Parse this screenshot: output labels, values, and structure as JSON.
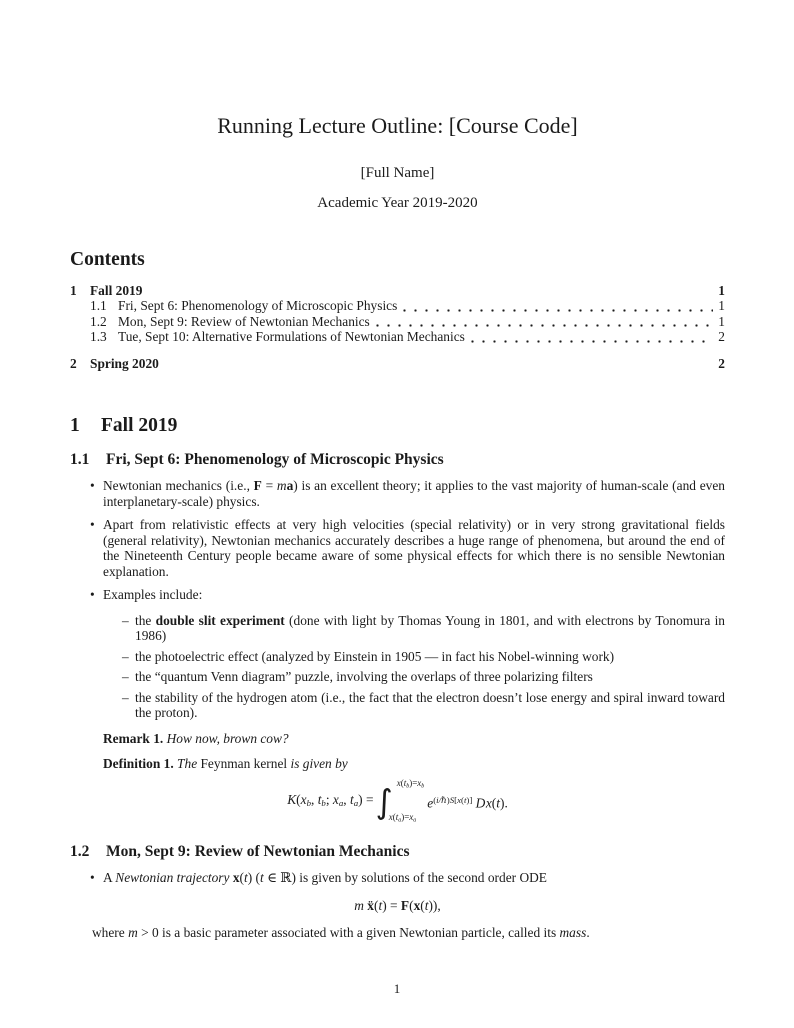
{
  "page": {
    "title": "Running Lecture Outline: [Course Code]",
    "author": "[Full Name]",
    "date": "Academic Year 2019-2020",
    "page_number": "1"
  },
  "markers": {
    "bullet": "•",
    "dash": "–"
  },
  "contents": {
    "heading": "Contents",
    "entries": [
      {
        "num": "1",
        "label": "Fall 2019",
        "page": "1"
      },
      {
        "num": "1.1",
        "label": "Fri, Sept 6: Phenomenology of Microscopic Physics",
        "page": "1"
      },
      {
        "num": "1.2",
        "label": "Mon, Sept 9: Review of Newtonian Mechanics",
        "page": "1"
      },
      {
        "num": "1.3",
        "label": "Tue, Sept 10: Alternative Formulations of Newtonian Mechanics",
        "page": "2"
      },
      {
        "num": "2",
        "label": "Spring 2020",
        "page": "2"
      }
    ]
  },
  "sections": {
    "s1": {
      "num": "1",
      "title": "Fall 2019"
    },
    "s11": {
      "num": "1.1",
      "title": "Fri, Sept 6: Phenomenology of Microscopic Physics"
    },
    "s12": {
      "num": "1.2",
      "title": "Mon, Sept 9: Review of Newtonian Mechanics"
    }
  },
  "body": {
    "bullet1": [
      {
        "t": "Newtonian mechanics (i.e., ",
        "s": "rm"
      },
      {
        "t": "F",
        "s": "bf"
      },
      {
        "t": " = ",
        "s": "rm"
      },
      {
        "t": "m",
        "s": "it"
      },
      {
        "t": "a",
        "s": "bf"
      },
      {
        "t": ") is an excellent theory; it applies to the vast majority of human-scale (and even interplanetary-scale) physics.",
        "s": "rm"
      }
    ],
    "bullet2": [
      {
        "t": "Apart from relativistic effects at very high velocities (special relativity) or in very strong gravitational fields (general relativity), Newtonian mechanics accurately describes a huge range of phenomena, but around the end of the Nineteenth Century people became aware of some physical effects for which there is no sensible Newtonian explanation.",
        "s": "rm"
      }
    ],
    "bullet3": [
      {
        "t": "Examples include:",
        "s": "rm"
      }
    ],
    "subs": [
      [
        {
          "t": "the ",
          "s": "rm"
        },
        {
          "t": "double slit experiment",
          "s": "bf"
        },
        {
          "t": " (done with light by Thomas Young in 1801, and with electrons by Tonomura in 1986)",
          "s": "rm"
        }
      ],
      [
        {
          "t": "the photoelectric effect (analyzed by Einstein in 1905 — in fact his Nobel-winning work)",
          "s": "rm"
        }
      ],
      [
        {
          "t": "the “quantum Venn diagram” puzzle, involving the overlaps of three polarizing filters",
          "s": "rm"
        }
      ],
      [
        {
          "t": "the stability of the hydrogen atom (i.e., the fact that the electron doesn’t lose energy and spiral inward toward the proton).",
          "s": "rm"
        }
      ]
    ],
    "remark": [
      {
        "t": "Remark 1.",
        "s": "bf"
      },
      {
        "t": " ",
        "s": "rm"
      },
      {
        "t": "How now, brown cow?",
        "s": "it"
      }
    ],
    "definition": [
      {
        "t": "Definition 1.",
        "s": "bf"
      },
      {
        "t": " ",
        "s": "rm"
      },
      {
        "t": "The ",
        "s": "it"
      },
      {
        "t": "Feynman kernel",
        "s": "rm"
      },
      {
        "t": " is given by",
        "s": "it"
      }
    ],
    "traj": [
      {
        "t": "A ",
        "s": "rm"
      },
      {
        "t": "Newtonian trajectory ",
        "s": "it"
      },
      {
        "t": "x",
        "s": "bf"
      },
      {
        "t": "(",
        "s": "rm"
      },
      {
        "t": "t",
        "s": "it"
      },
      {
        "t": ") (",
        "s": "rm"
      },
      {
        "t": "t",
        "s": "it"
      },
      {
        "t": " ∈ ℝ) is given by solutions of the second order ODE",
        "s": "rm"
      }
    ],
    "where_line": [
      {
        "t": "where ",
        "s": "rm"
      },
      {
        "t": "m",
        "s": "it"
      },
      {
        "t": " > 0 is a basic parameter associated with a given Newtonian particle, called its ",
        "s": "rm"
      },
      {
        "t": "mass",
        "s": "it"
      },
      {
        "t": ".",
        "s": "rm"
      }
    ]
  },
  "math": {
    "integral_sign": "∫",
    "kernel_lhs": [
      {
        "t": "K",
        "s": "it"
      },
      {
        "t": "(",
        "s": "rm"
      },
      {
        "t": "x",
        "s": "it"
      },
      {
        "t": "b",
        "s": "it sub"
      },
      {
        "t": ", ",
        "s": "rm"
      },
      {
        "t": "t",
        "s": "it"
      },
      {
        "t": "b",
        "s": "it sub"
      },
      {
        "t": "; ",
        "s": "rm"
      },
      {
        "t": "x",
        "s": "it"
      },
      {
        "t": "a",
        "s": "it sub"
      },
      {
        "t": ", ",
        "s": "rm"
      },
      {
        "t": "t",
        "s": "it"
      },
      {
        "t": "a",
        "s": "it sub"
      },
      {
        "t": ") = ",
        "s": "rm"
      }
    ],
    "kernel_upper": [
      {
        "t": "x",
        "s": "it"
      },
      {
        "t": "(",
        "s": "rm"
      },
      {
        "t": "t",
        "s": "it"
      },
      {
        "t": "b",
        "s": "it sub"
      },
      {
        "t": ")=",
        "s": "rm"
      },
      {
        "t": "x",
        "s": "it"
      },
      {
        "t": "b",
        "s": "it sub"
      }
    ],
    "kernel_lower": [
      {
        "t": "x",
        "s": "it"
      },
      {
        "t": "(",
        "s": "rm"
      },
      {
        "t": "t",
        "s": "it"
      },
      {
        "t": "a",
        "s": "it sub"
      },
      {
        "t": ")=",
        "s": "rm"
      },
      {
        "t": "x",
        "s": "it"
      },
      {
        "t": "a",
        "s": "it sub"
      }
    ],
    "kernel_rhs": [
      {
        "t": "e",
        "s": "it"
      },
      {
        "t": "(",
        "s": "sup rm"
      },
      {
        "t": "i/ℏ",
        "s": "sup it"
      },
      {
        "t": ")",
        "s": "sup rm"
      },
      {
        "t": "S",
        "s": "sup it"
      },
      {
        "t": "[",
        "s": "sup rm"
      },
      {
        "t": "x",
        "s": "sup it"
      },
      {
        "t": "(",
        "s": "sup rm"
      },
      {
        "t": "t",
        "s": "sup it"
      },
      {
        "t": ")]",
        "s": "sup rm"
      },
      {
        "t": " ",
        "s": "rm"
      },
      {
        "t": "D",
        "s": "script"
      },
      {
        "t": "x",
        "s": "it"
      },
      {
        "t": "(",
        "s": "rm"
      },
      {
        "t": "t",
        "s": "it"
      },
      {
        "t": ").",
        "s": "rm"
      }
    ],
    "newton_ode": [
      {
        "t": "m",
        "s": "it"
      },
      {
        "t": " ",
        "s": "rm"
      },
      {
        "t": "ẍ",
        "s": "bf"
      },
      {
        "t": "(",
        "s": "rm"
      },
      {
        "t": "t",
        "s": "it"
      },
      {
        "t": ") = ",
        "s": "rm"
      },
      {
        "t": "F",
        "s": "bf"
      },
      {
        "t": "(",
        "s": "rm"
      },
      {
        "t": "x",
        "s": "bf"
      },
      {
        "t": "(",
        "s": "rm"
      },
      {
        "t": "t",
        "s": "it"
      },
      {
        "t": ")),",
        "s": "rm"
      }
    ]
  }
}
